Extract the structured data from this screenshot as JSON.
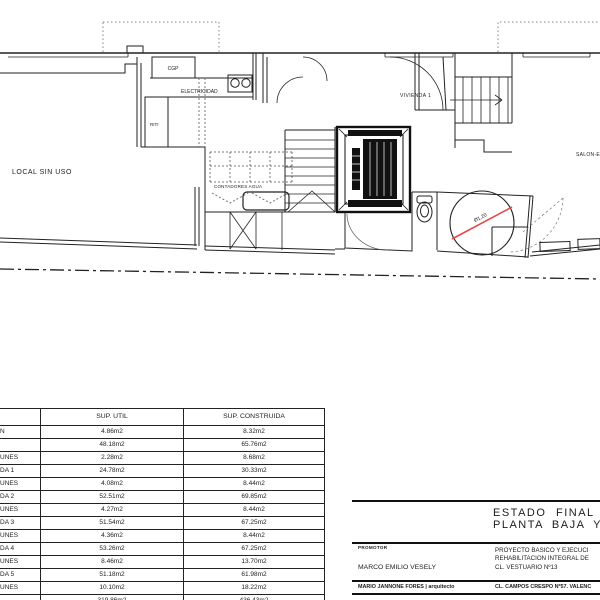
{
  "plan": {
    "labels": {
      "local": "LOCAL SIN USO",
      "cgp": "CGP",
      "electricidad": "ELECTRICIDAD",
      "riti": "RITI",
      "contadores": "CONTADORES AGUA",
      "vivienda1": "VIVIENDA 1",
      "salon": "SALON-E",
      "diameter": "Ø1,20"
    },
    "accent_color": "#e74848"
  },
  "table": {
    "headers": {
      "col1": "",
      "util": "SUP. UTIL",
      "construida": "SUP. CONSTRUIDA"
    },
    "rows": [
      {
        "label": "N",
        "util": "4.86m2",
        "construida": "8.32m2"
      },
      {
        "label": "",
        "util": "48.18m2",
        "construida": "65.76m2"
      },
      {
        "label": "UNES",
        "util": "2.28m2",
        "construida": "8.68m2"
      },
      {
        "label": "DA 1",
        "util": "24.78m2",
        "construida": "30.33m2"
      },
      {
        "label": "UNES",
        "util": "4.08m2",
        "construida": "8.44m2"
      },
      {
        "label": "DA 2",
        "util": "52.51m2",
        "construida": "69.85m2"
      },
      {
        "label": "UNES",
        "util": "4.27m2",
        "construida": "8.44m2"
      },
      {
        "label": "DA 3",
        "util": "51.54m2",
        "construida": "67.25m2"
      },
      {
        "label": "UNES",
        "util": "4.36m2",
        "construida": "8.44m2"
      },
      {
        "label": "DA 4",
        "util": "53.26m2",
        "construida": "67.25m2"
      },
      {
        "label": "UNES",
        "util": "8.46m2",
        "construida": "13.70m2"
      },
      {
        "label": "DA 5",
        "util": "51.18m2",
        "construida": "61.98m2"
      },
      {
        "label": "UNES",
        "util": "10.10m2",
        "construida": "18.22m2"
      },
      {
        "label": "",
        "util": "319.86m2",
        "construida": "436.43m2"
      }
    ]
  },
  "titleblock": {
    "title_line1": "ESTADO FINAL",
    "title_line2": "PLANTA BAJA Y EN",
    "promotor_label": "PROMOTOR",
    "promotor_name": "MARCO EMILIO VESELY",
    "project_line1": "PROYECTO BASICO Y EJECUCI",
    "project_line2": "REHABILITACION INTEGRAL DE",
    "project_line3": "CL. VESTUARIO Nº13",
    "architect": "MARIO JANNONE FORES | arquitecto",
    "address": "CL. CAMPOS CRESPO Nº57. VALENC"
  }
}
